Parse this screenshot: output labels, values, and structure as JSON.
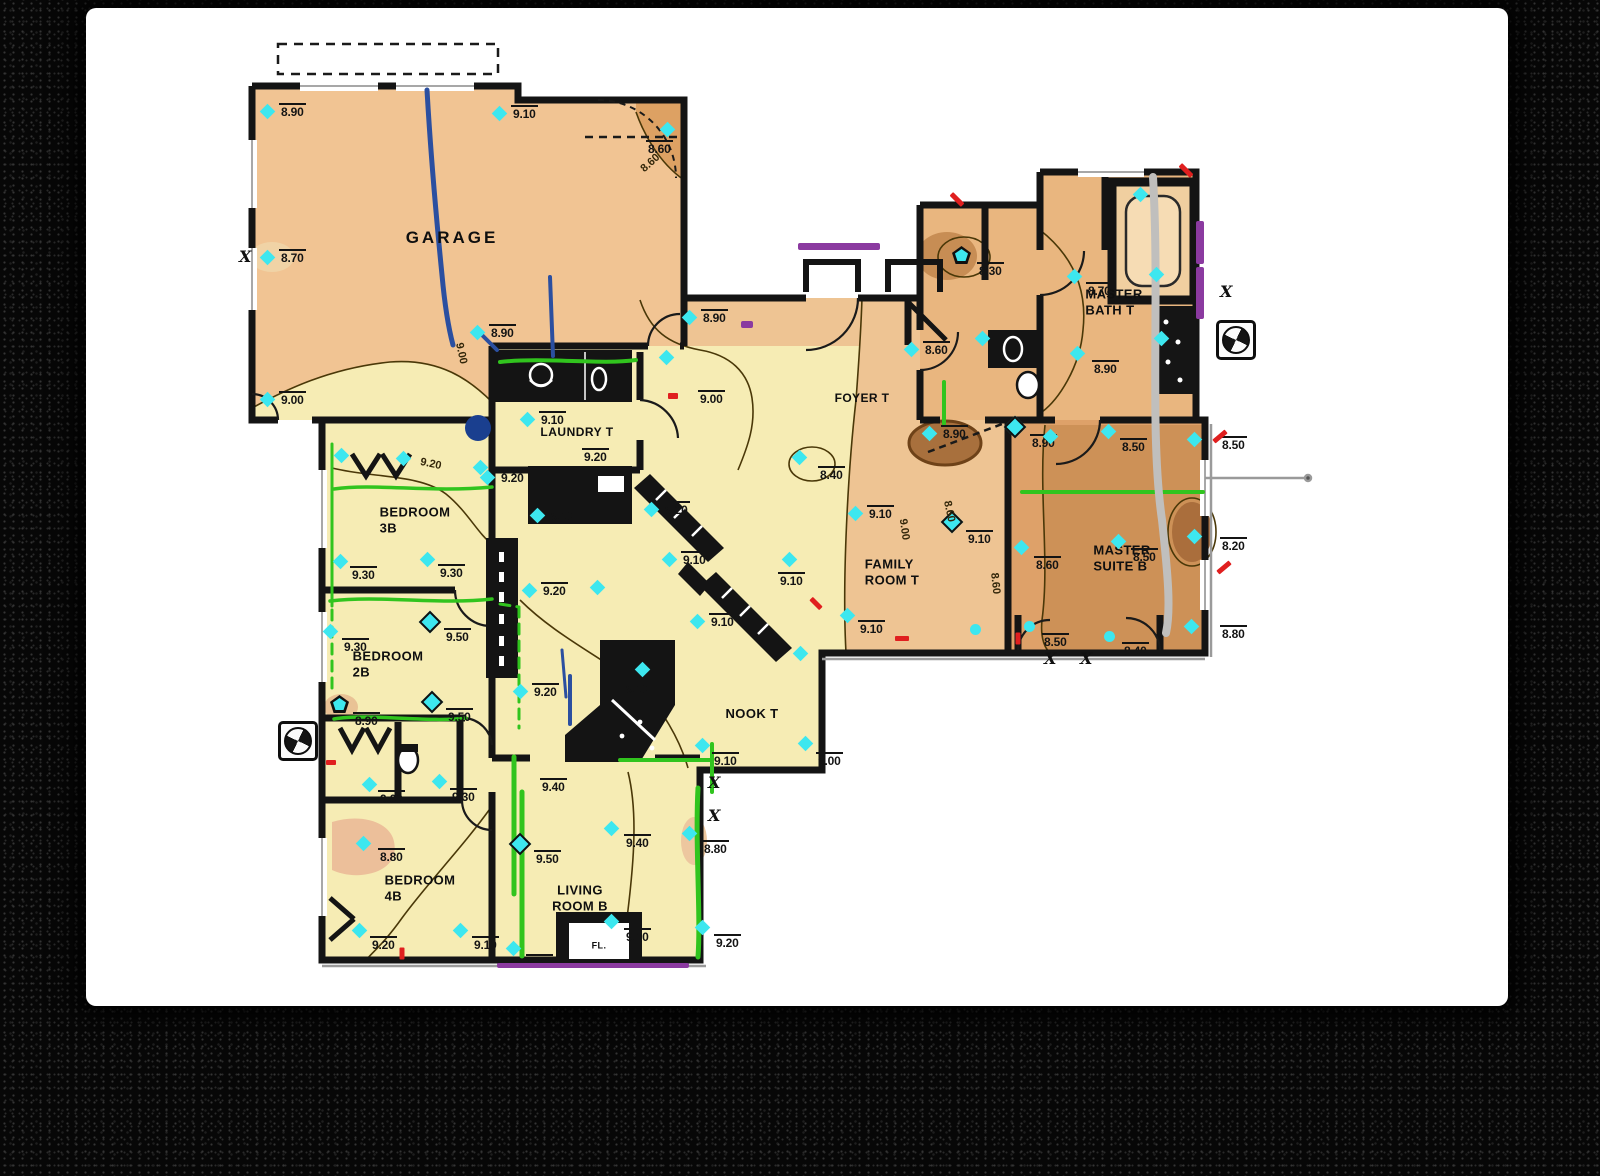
{
  "colors": {
    "paper": "#ffffff",
    "frame": "#070707",
    "wall": "#141414",
    "marker_cyan": "#3de7ef",
    "crack_green": "#31c41e",
    "crack_blue": "#2b4fa0",
    "crack_gray": "#c0bfbd",
    "note_purple": "#8b3aa0",
    "tick_red": "#e01f1f",
    "contour": "#4a3808",
    "fill_yellow": "#f6ecb4",
    "fill_tan": "#eec493",
    "fill_dark_tan": "#dea169",
    "fill_brown": "#cd9157",
    "fill_deep_brown": "#a8703d"
  },
  "plan": {
    "rooms": [
      {
        "name": "garage",
        "label": "GARAGE",
        "x": 452,
        "y": 238,
        "fs": 17,
        "ls": 3,
        "center": true
      },
      {
        "name": "laundry",
        "label": "LAUNDRY T",
        "x": 577,
        "y": 432,
        "fs": 12,
        "ls": 0.5,
        "center": true
      },
      {
        "name": "bedroom-3b",
        "label": "BEDROOM\n3B",
        "x": 415,
        "y": 520,
        "fs": 13
      },
      {
        "name": "bedroom-2b",
        "label": "BEDROOM\n2B",
        "x": 388,
        "y": 664,
        "fs": 13
      },
      {
        "name": "bedroom-4b",
        "label": "BEDROOM\n4B",
        "x": 420,
        "y": 888,
        "fs": 13
      },
      {
        "name": "living-room",
        "label": "LIVING\nROOM B",
        "x": 580,
        "y": 898,
        "fs": 13,
        "center": true
      },
      {
        "name": "nook",
        "label": "NOOK T",
        "x": 752,
        "y": 714,
        "fs": 13,
        "center": true
      },
      {
        "name": "family-room",
        "label": "FAMILY\nROOM T",
        "x": 892,
        "y": 572,
        "fs": 13
      },
      {
        "name": "foyer",
        "label": "FOYER T",
        "x": 862,
        "y": 398,
        "fs": 12,
        "center": true
      },
      {
        "name": "master-bath",
        "label": "MASTER\nBATH T",
        "x": 1114,
        "y": 302,
        "fs": 13
      },
      {
        "name": "master-suite",
        "label": "MASTER\nSUITE B",
        "x": 1122,
        "y": 558,
        "fs": 13
      },
      {
        "name": "closet-fl",
        "label": "FL.",
        "x": 599,
        "y": 946,
        "fs": 9,
        "center": true
      }
    ],
    "spot_elevations": [
      {
        "x": 268,
        "y": 112,
        "v": "8.90"
      },
      {
        "x": 500,
        "y": 114,
        "v": "9.10"
      },
      {
        "x": 668,
        "y": 130,
        "v": "8.60",
        "lx": 646,
        "ly": 140
      },
      {
        "x": 268,
        "y": 258,
        "v": "8.70"
      },
      {
        "x": 268,
        "y": 400,
        "v": "9.00"
      },
      {
        "x": 478,
        "y": 333,
        "v": "8.90"
      },
      {
        "x": 690,
        "y": 318,
        "v": "8.90"
      },
      {
        "x": 667,
        "y": 358,
        "v": "9.00",
        "lx": 698,
        "ly": 390
      },
      {
        "x": 528,
        "y": 420,
        "v": "9.10"
      },
      {
        "x": 575,
        "y": 450,
        "v": "9.20",
        "s": "plain",
        "lx": 582,
        "ly": 448
      },
      {
        "x": 488,
        "y": 478,
        "v": "9.20"
      },
      {
        "x": 538,
        "y": 516,
        "v": "9.10"
      },
      {
        "x": 530,
        "y": 591,
        "v": "9.20"
      },
      {
        "x": 521,
        "y": 692,
        "v": "9.20"
      },
      {
        "x": 652,
        "y": 510,
        "v": "9.20"
      },
      {
        "x": 670,
        "y": 560,
        "v": "9.10"
      },
      {
        "x": 598,
        "y": 588
      },
      {
        "x": 912,
        "y": 350,
        "v": "8.60"
      },
      {
        "x": 930,
        "y": 434,
        "v": "8.90"
      },
      {
        "x": 800,
        "y": 458,
        "v": "8.40",
        "lx": 818,
        "ly": 466
      },
      {
        "x": 856,
        "y": 514,
        "v": "9.10"
      },
      {
        "x": 790,
        "y": 560,
        "v": "9.10",
        "lx": 778,
        "ly": 572
      },
      {
        "x": 848,
        "y": 616,
        "v": "9.10",
        "lx": 858,
        "ly": 620
      },
      {
        "x": 952,
        "y": 522,
        "v": "9.10",
        "s": "o",
        "lx": 966,
        "ly": 530
      },
      {
        "x": 1022,
        "y": 548,
        "v": "8.60",
        "lx": 1034,
        "ly": 556
      },
      {
        "x": 976,
        "y": 630,
        "s": "dot"
      },
      {
        "x": 698,
        "y": 622,
        "v": "9.10"
      },
      {
        "x": 643,
        "y": 670,
        "v": "9.10",
        "lx": 624,
        "ly": 680
      },
      {
        "x": 703,
        "y": 746,
        "v": "9.10",
        "lx": 712,
        "ly": 752
      },
      {
        "x": 806,
        "y": 744,
        "v": "9.00",
        "lx": 816,
        "ly": 752
      },
      {
        "x": 801,
        "y": 654
      },
      {
        "x": 342,
        "y": 456
      },
      {
        "x": 404,
        "y": 459
      },
      {
        "x": 341,
        "y": 562,
        "v": "9.30",
        "lx": 350,
        "ly": 566
      },
      {
        "x": 428,
        "y": 560,
        "v": "9.30",
        "lx": 438,
        "ly": 564
      },
      {
        "x": 481,
        "y": 468
      },
      {
        "x": 331,
        "y": 632,
        "v": "9.30",
        "lx": 342,
        "ly": 638
      },
      {
        "x": 430,
        "y": 622,
        "v": "9.50",
        "s": "o",
        "lx": 444,
        "ly": 628
      },
      {
        "x": 432,
        "y": 702,
        "v": "9.50",
        "s": "o",
        "lx": 446,
        "ly": 708
      },
      {
        "x": 339,
        "y": 704,
        "v": "8.90",
        "s": "p",
        "lx": 353,
        "ly": 712
      },
      {
        "x": 370,
        "y": 785,
        "v": "9.00",
        "lx": 378,
        "ly": 790
      },
      {
        "x": 440,
        "y": 782,
        "v": "9.30",
        "lx": 450,
        "ly": 788
      },
      {
        "x": 364,
        "y": 844,
        "v": "8.80",
        "lx": 378,
        "ly": 848
      },
      {
        "x": 360,
        "y": 931,
        "v": "9.20",
        "lx": 370,
        "ly": 936
      },
      {
        "x": 461,
        "y": 931,
        "v": "9.10",
        "lx": 472,
        "ly": 936
      },
      {
        "x": 520,
        "y": 844,
        "v": "9.50",
        "s": "o",
        "lx": 534,
        "ly": 850
      },
      {
        "x": 612,
        "y": 829,
        "v": "9.40",
        "lx": 624,
        "ly": 834
      },
      {
        "x": 556,
        "y": 780,
        "v": "9.40",
        "s": "plain",
        "lx": 540,
        "ly": 778
      },
      {
        "x": 690,
        "y": 834,
        "v": "8.80",
        "lx": 702,
        "ly": 840
      },
      {
        "x": 612,
        "y": 922,
        "v": "9.10",
        "lx": 624,
        "ly": 928
      },
      {
        "x": 514,
        "y": 949,
        "v": "9.30",
        "lx": 526,
        "ly": 954
      },
      {
        "x": 703,
        "y": 928,
        "v": "9.20",
        "lx": 714,
        "ly": 934
      },
      {
        "x": 961,
        "y": 255,
        "v": "8.30",
        "s": "p",
        "lx": 977,
        "ly": 262
      },
      {
        "x": 1075,
        "y": 277,
        "v": "8.70",
        "lx": 1086,
        "ly": 282
      },
      {
        "x": 1141,
        "y": 195
      },
      {
        "x": 1078,
        "y": 354,
        "v": "8.90",
        "lx": 1092,
        "ly": 360
      },
      {
        "x": 1157,
        "y": 275
      },
      {
        "x": 1162,
        "y": 339
      },
      {
        "x": 983,
        "y": 339
      },
      {
        "x": 1015,
        "y": 427,
        "v": "8.90",
        "s": "o",
        "lx": 1030,
        "ly": 434
      },
      {
        "x": 1051,
        "y": 437
      },
      {
        "x": 1109,
        "y": 432,
        "v": "8.50",
        "lx": 1120,
        "ly": 438
      },
      {
        "x": 1119,
        "y": 542,
        "v": "8.50",
        "lx": 1131,
        "ly": 548
      },
      {
        "x": 1195,
        "y": 440
      },
      {
        "x": 1195,
        "y": 537
      },
      {
        "x": 1192,
        "y": 627
      },
      {
        "x": 1110,
        "y": 637,
        "v": "8.40",
        "s": "dot",
        "lx": 1122,
        "ly": 642
      },
      {
        "x": 1030,
        "y": 627,
        "v": "8.50",
        "s": "dot",
        "lx": 1042,
        "ly": 633
      },
      {
        "x": 1209,
        "y": 445,
        "v": "8.50",
        "s": "plain"
      },
      {
        "x": 1209,
        "y": 546,
        "v": "8.20",
        "s": "plain"
      },
      {
        "x": 1209,
        "y": 634,
        "v": "8.80",
        "s": "plain"
      }
    ],
    "contour_labels": [
      {
        "x": 450,
        "y": 348,
        "v": "9.00",
        "rot": 78
      },
      {
        "x": 640,
        "y": 158,
        "v": "8.60",
        "rot": -42
      },
      {
        "x": 420,
        "y": 459,
        "v": "9.20",
        "rot": 12
      },
      {
        "x": 893,
        "y": 524,
        "v": "9.00",
        "rot": 82
      },
      {
        "x": 984,
        "y": 578,
        "v": "8.60",
        "rot": 84
      },
      {
        "x": 938,
        "y": 506,
        "v": "8.60",
        "rot": 78
      }
    ],
    "x_mark_glyph": "X",
    "x_marks": [
      {
        "x": 246,
        "y": 259
      },
      {
        "x": 715,
        "y": 785
      },
      {
        "x": 715,
        "y": 818
      },
      {
        "x": 1051,
        "y": 661
      },
      {
        "x": 1087,
        "y": 661
      },
      {
        "x": 1227,
        "y": 294
      }
    ],
    "benchmark_icons": [
      {
        "x": 298,
        "y": 741
      },
      {
        "x": 1236,
        "y": 340
      }
    ],
    "red_ticks": [
      {
        "x": 957,
        "y": 199,
        "rot": 45,
        "w": 16,
        "h": 5
      },
      {
        "x": 1186,
        "y": 170,
        "rot": 45,
        "w": 16,
        "h": 5
      },
      {
        "x": 1220,
        "y": 436,
        "rot": -40,
        "w": 16,
        "h": 5
      },
      {
        "x": 1224,
        "y": 567,
        "rot": -40,
        "w": 16,
        "h": 5
      },
      {
        "x": 902,
        "y": 638,
        "rot": 0,
        "w": 14,
        "h": 5
      },
      {
        "x": 673,
        "y": 396,
        "rot": 0,
        "w": 10,
        "h": 6
      },
      {
        "x": 816,
        "y": 603,
        "rot": 45,
        "w": 14,
        "h": 5
      },
      {
        "x": 402,
        "y": 953,
        "rot": 90,
        "w": 12,
        "h": 5
      },
      {
        "x": 331,
        "y": 762,
        "rot": 0,
        "w": 10,
        "h": 5
      },
      {
        "x": 1018,
        "y": 638,
        "rot": 90,
        "w": 12,
        "h": 5
      }
    ],
    "purple_marks": [
      {
        "x": 798,
        "y": 243,
        "w": 82,
        "h": 7
      },
      {
        "x": 1196,
        "y": 221,
        "w": 8,
        "h": 43
      },
      {
        "x": 1196,
        "y": 267,
        "w": 8,
        "h": 52
      },
      {
        "x": 497,
        "y": 963,
        "w": 192,
        "h": 5
      },
      {
        "x": 741,
        "y": 321,
        "w": 12,
        "h": 7
      }
    ],
    "crack_lines": {
      "blue": [
        {
          "d": "M427,90 C431,160 437,225 442,275 C445,308 449,330 453,345",
          "w": 5
        },
        {
          "d": "M550,277 L553,356",
          "w": 4
        },
        {
          "d": "M478,331 L497,350",
          "w": 4
        },
        {
          "d": "M570,676 L570,724",
          "w": 4
        },
        {
          "d": "M562,650 L566,697",
          "w": 3
        }
      ],
      "blue_dots": [
        {
          "x": 478,
          "y": 428,
          "r": 13
        }
      ],
      "green": [
        {
          "d": "M332,444 L332,606",
          "w": 3
        },
        {
          "d": "M332,610 L332,692",
          "w": 3,
          "dash": true
        },
        {
          "d": "M334,489 C375,483 430,493 492,487",
          "w": 3.5
        },
        {
          "d": "M330,601 C380,595 440,605 492,599",
          "w": 3.5
        },
        {
          "d": "M334,719 C368,713 430,723 466,718",
          "w": 3.5
        },
        {
          "d": "M500,604 L519,607 M519,607 L519,728",
          "w": 3,
          "dash": true
        },
        {
          "d": "M500,362 C545,357 600,365 636,360",
          "w": 4
        },
        {
          "d": "M514,757 L514,894",
          "w": 5
        },
        {
          "d": "M522,792 L522,956",
          "w": 5
        },
        {
          "d": "M698,788 C695,845 701,915 698,957",
          "w": 5
        },
        {
          "d": "M620,760 L712,760 M712,744 L712,792",
          "w": 4
        },
        {
          "d": "M944,382 L944,424",
          "w": 4
        },
        {
          "d": "M1022,492 L1203,492",
          "w": 4
        }
      ],
      "gray": [
        {
          "d": "M1153,177 C1160,300 1149,430 1162,520 C1168,575 1171,610 1166,633",
          "w": 8
        }
      ]
    }
  }
}
